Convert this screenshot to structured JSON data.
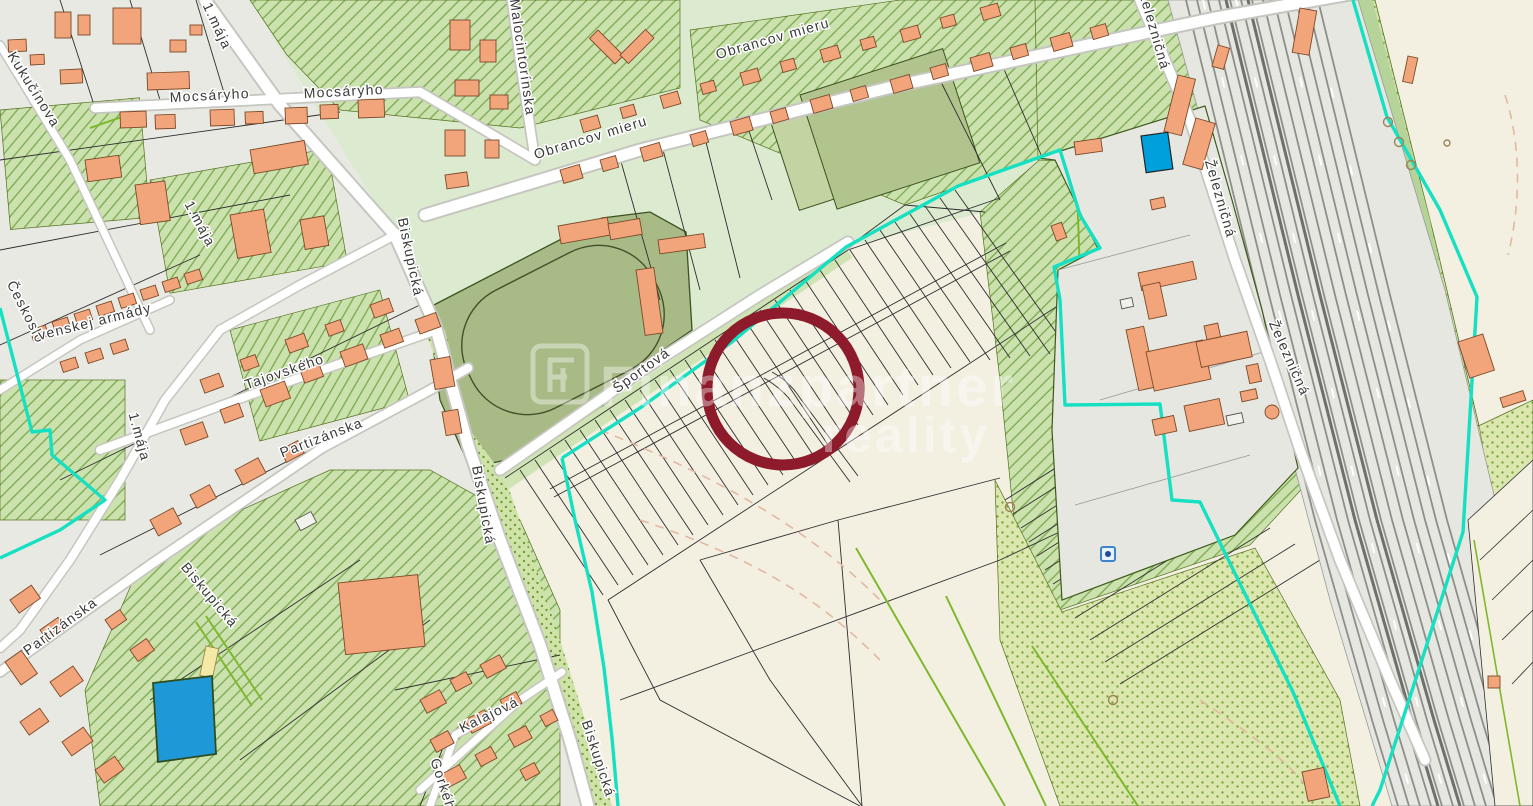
{
  "map": {
    "kind": "cadastral-map-screenshot",
    "watermark": {
      "logo_letter": "F",
      "line1": "Finanzpartner",
      "line2": "reality"
    },
    "streets": {
      "maja": "1.mája",
      "kukucinova": "Kukučínova",
      "mocsaryho": "Mocsáryho",
      "malocintorinska": "Malocintorínska",
      "obrancov_mieru": "Obrancov mieru",
      "biskupicka": "Biskupická",
      "sportova": "Športová",
      "tajovskeho": "Tajovského",
      "partizanska": "Partizánska",
      "ceskoslovenskej_armady_part1": "Českoslo",
      "ceskoslovenskej_armady_part2": "venskej armády",
      "kalajova": "Kalajová",
      "gorkeho": "Gorkého",
      "zeleznicna": "Železničná"
    },
    "annotation": {
      "shape": "circle",
      "color": "#8d1b2b"
    },
    "colors": {
      "background_field": "#f3f0e2",
      "urban_base": "#e9e9e3",
      "building_orange": "#f2a47b",
      "green_hatch_base": "#cbe2af",
      "green_dark_field": "#aabb84",
      "cadastral_boundary_teal": "#15e0c2",
      "water_blue": "#1f98d8",
      "pool_blue": "#00a0dc",
      "railway_gray": "#e7e7e2",
      "highlight_red": "#8d1b2b",
      "lime_parcel_line": "#7fb82e"
    }
  }
}
